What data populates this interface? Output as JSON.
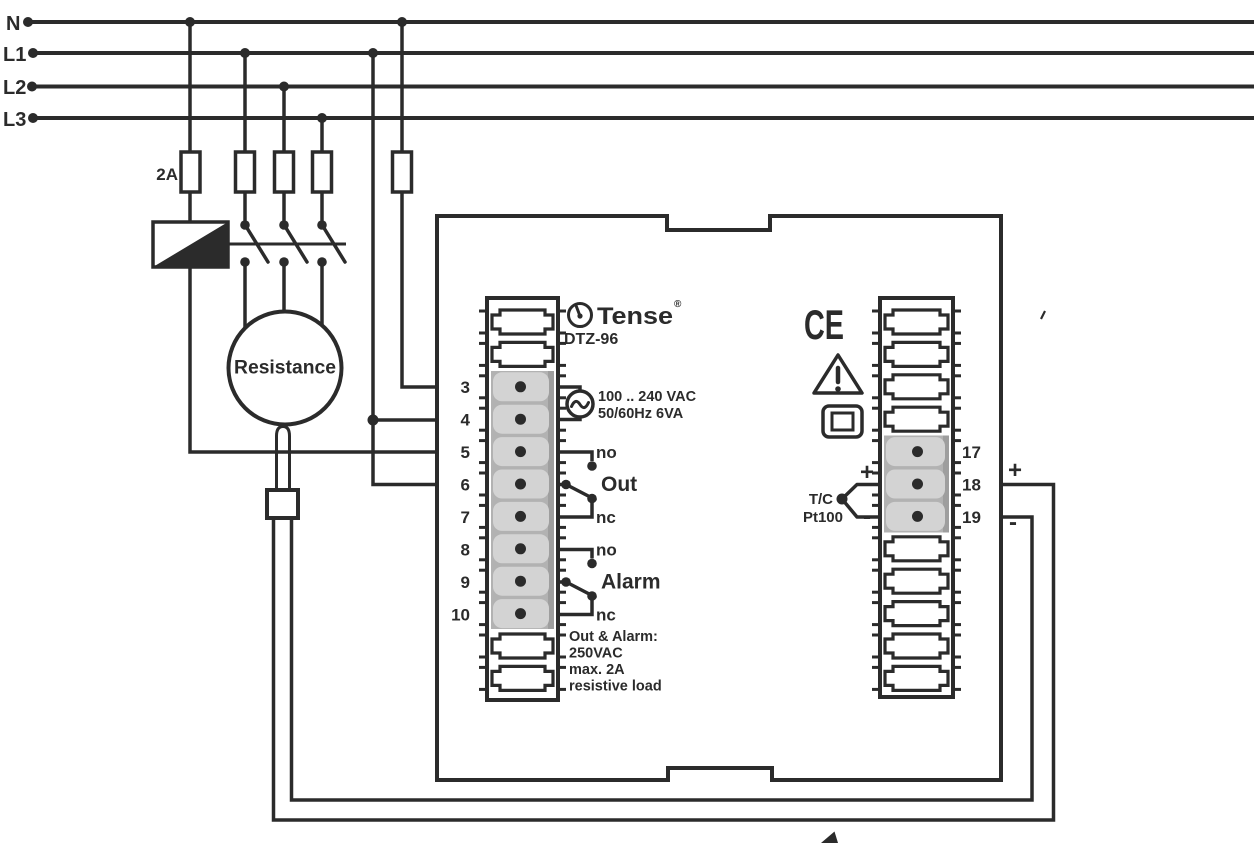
{
  "diagram": {
    "rails": [
      {
        "label": "N"
      },
      {
        "label": "L1"
      },
      {
        "label": "L2"
      },
      {
        "label": "L3"
      }
    ],
    "fuse_rating": "2A",
    "heater_label": "Resistance",
    "device": {
      "brand": "Tense",
      "registered_mark": "®",
      "model": "DTZ-96",
      "ce_mark": "CE",
      "warning_mark": "!",
      "supply_line1": "100 .. 240 VAC",
      "supply_line2": "50/60Hz 6VA",
      "out_relay": {
        "no": "no",
        "label": "Out",
        "nc": "nc"
      },
      "alarm_relay": {
        "no": "no",
        "label": "Alarm",
        "nc": "nc"
      },
      "rating_lines": [
        "Out & Alarm:",
        "250VAC",
        "max. 2A",
        "resistive load"
      ],
      "left_terminals": [
        "3",
        "4",
        "5",
        "6",
        "7",
        "8",
        "9",
        "10"
      ],
      "right_terminals": [
        "17",
        "18",
        "19"
      ],
      "sensor": {
        "type1": "T/C",
        "type2": "Pt100",
        "plus": "+",
        "minus": "-"
      }
    },
    "external": {
      "plus": "+",
      "minus": "-"
    },
    "colors": {
      "line": "#2b2b2b",
      "terminal_band": "#b2b2b2",
      "terminal_band_shade": "#9e9e9e",
      "terminal_clamp": "#d3d3d3",
      "background": "#ffffff"
    }
  }
}
